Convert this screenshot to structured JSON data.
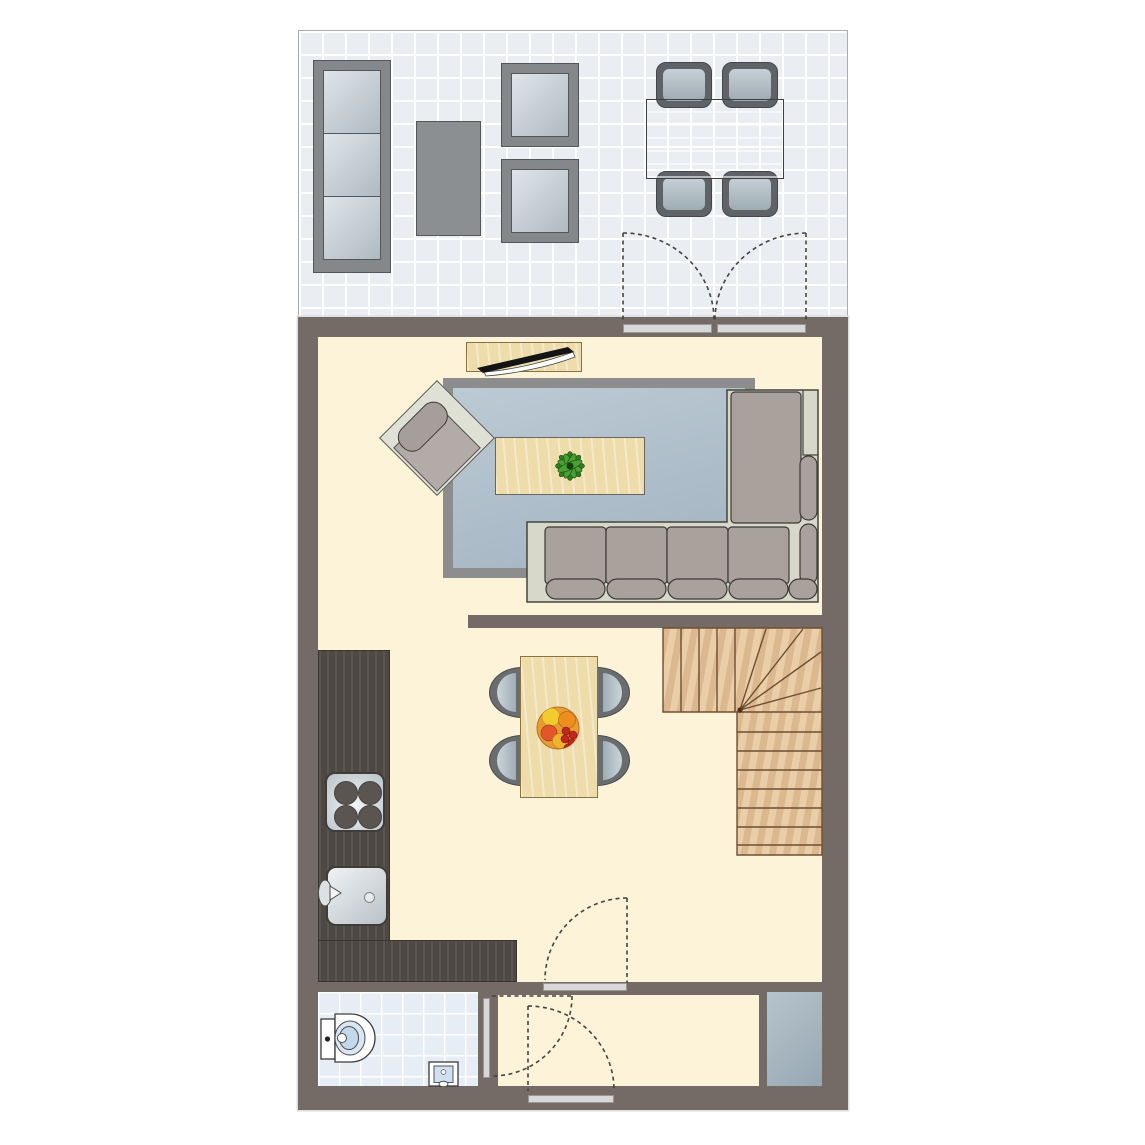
{
  "document": {
    "type": "floor-plan",
    "visible_text": []
  },
  "colors": {
    "wall": "#746B66",
    "floor": "#FCF3D8",
    "terraceTile": "#EAEEF3",
    "tileLine": "#FFFFFF",
    "outdoorFrame": "#85888B",
    "outdoorTable": "#8C8F92",
    "patioTableTop": "#B7C1C8",
    "rug": "#B2C2CD",
    "rugBorder": "#8D8D8D",
    "wood": "#EEDCAB",
    "woodBorder": "#8A7340",
    "counter": "#4E4843",
    "stairs": "#E2C199",
    "stairLine": "#6F4F33",
    "sofaBase": "#D7D8CA",
    "sofaCushion": "#A8A19C",
    "bathTile": "#E6EDF4",
    "closet": "#A9B8C2",
    "dash": "#44433D",
    "sill": "#D8D8D8",
    "metalLight": "#EFF2F3",
    "metalDark": "#B9C2C8",
    "burner": "#5A5551",
    "plantGreen": "#3E8E28",
    "fruitOrange": "#EE8E1F",
    "fruitYellow": "#F2CC2E",
    "fruitRed": "#C1271D"
  },
  "rooms": [
    {
      "name": "terrace",
      "floor_finish": "white-tile-grid"
    },
    {
      "name": "living-room",
      "floor_finish": "cream"
    },
    {
      "name": "kitchen-dining",
      "floor_finish": "cream"
    },
    {
      "name": "hallway",
      "floor_finish": "cream"
    },
    {
      "name": "bathroom",
      "floor_finish": "light-blue-tile"
    },
    {
      "name": "storage-closet",
      "floor_finish": "blue-gray"
    }
  ],
  "furniture": [
    "outdoor-3-seat-sofa",
    "outdoor-coffee-table",
    "outdoor-lounge-chair-top",
    "outdoor-lounge-chair-bottom",
    "patio-dining-table",
    "patio-chair-top-left",
    "patio-chair-top-right",
    "patio-chair-bottom-left",
    "patio-chair-bottom-right",
    "tv-sideboard",
    "flat-tv",
    "area-rug",
    "corner-sofa",
    "coffee-table-with-plant",
    "accent-armchair",
    "kitchen-counter-l-shape",
    "cooktop-4-burner",
    "kitchen-sink",
    "dining-table",
    "dining-chair-x4",
    "fruit-bowl",
    "winder-staircase",
    "toilet",
    "hand-basin",
    "french-doors-to-terrace",
    "interior-door-living",
    "bathroom-door",
    "front-door"
  ],
  "counts": {
    "stove_burners": 4,
    "dining_chairs": 4,
    "patio_chairs": 4,
    "outdoor_sofa_seats": 3,
    "sofa_seat_cushions": 4,
    "stair_upper_treads": 4,
    "stair_winder_treads": 5,
    "stair_lower_treads": 8,
    "hinged_doors": 3,
    "french_door_leaves": 2
  }
}
